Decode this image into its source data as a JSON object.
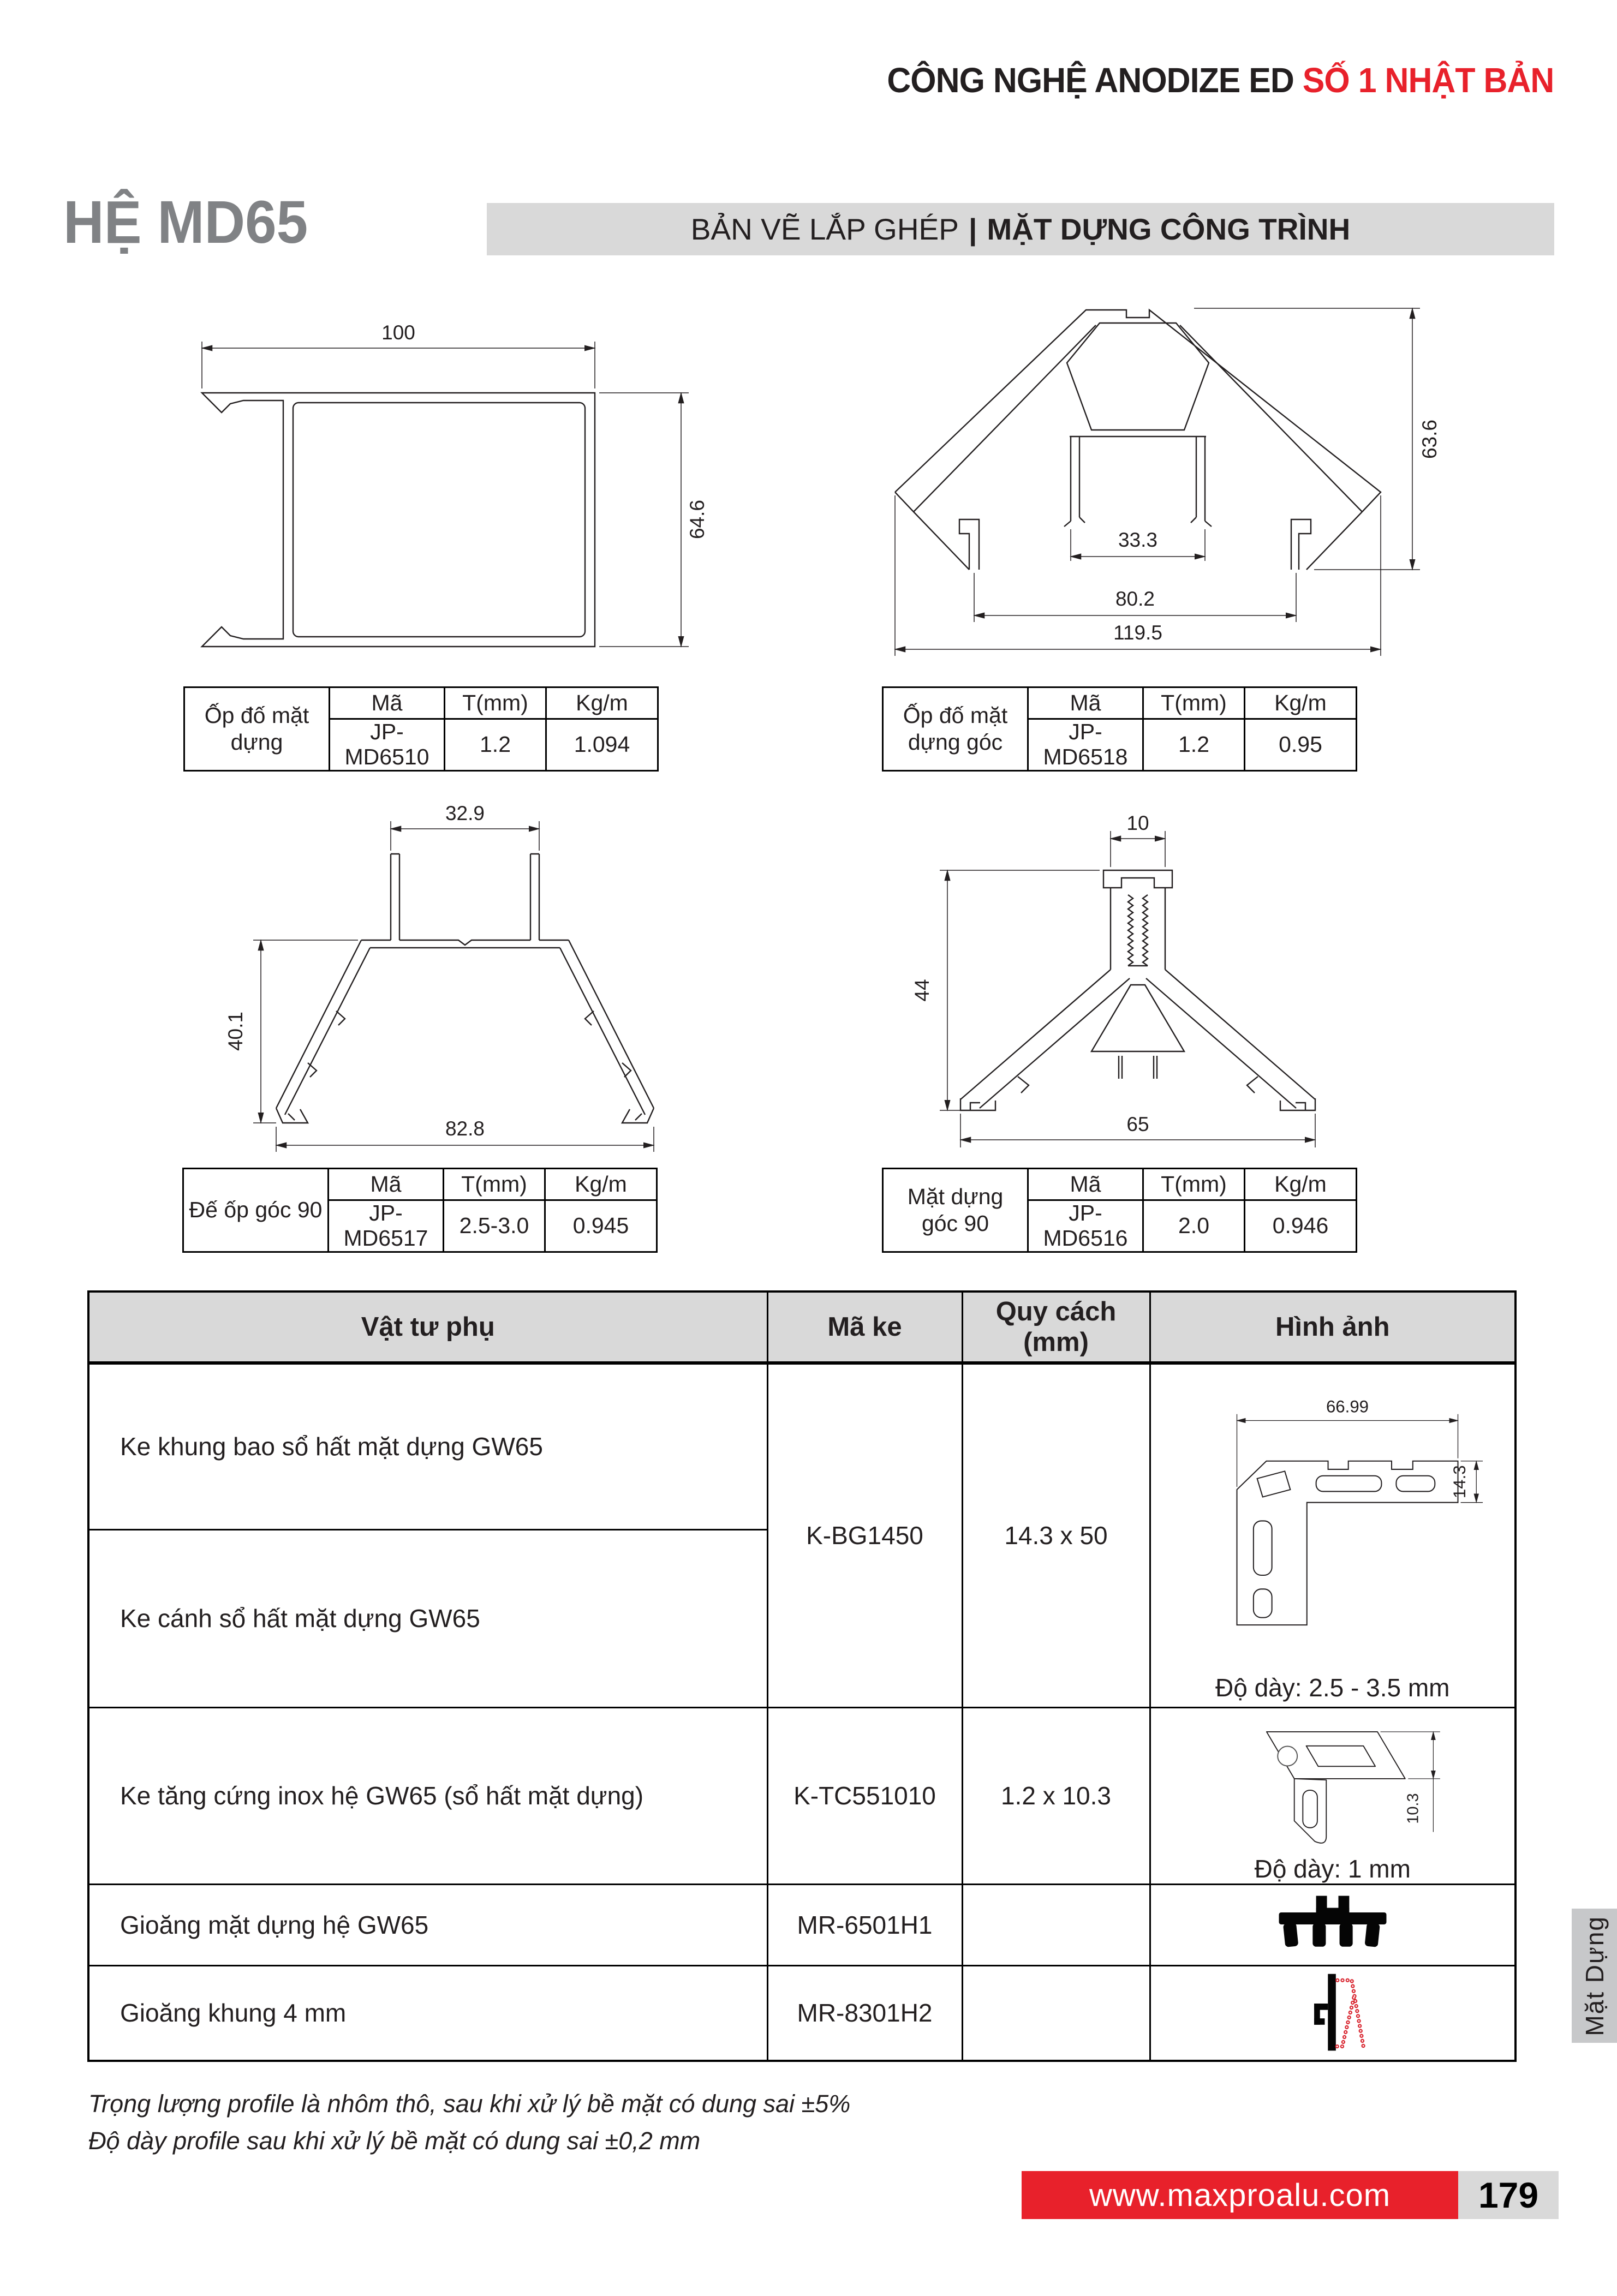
{
  "header": {
    "title_black": "CÔNG NGHỆ ANODIZE ED",
    "title_red": "SỐ 1 NHẬT BẢN"
  },
  "intro": {
    "system": "HỆ MD65",
    "banner_left": "BẢN VẼ LẮP GHÉP",
    "banner_divider": "|",
    "banner_right": "MẶT DỰNG CÔNG TRÌNH"
  },
  "mini_table_headers": {
    "ma": "Mã",
    "t": "T(mm)",
    "kg": "Kg/m"
  },
  "profiles": [
    {
      "name_l1": "Ốp đố mặt",
      "name_l2": "dựng",
      "ma": "JP-MD6510",
      "t": "1.2",
      "kg": "1.094",
      "dims": {
        "w": "100",
        "h": "64.6"
      }
    },
    {
      "name_l1": "Ốp đố mặt",
      "name_l2": "dựng góc",
      "ma": "JP-MD6518",
      "t": "1.2",
      "kg": "0.95",
      "dims": {
        "inner": "33.3",
        "h": "63.6",
        "mid": "80.2",
        "w": "119.5"
      }
    },
    {
      "name_l1": "Đế ốp góc 90",
      "name_l2": "",
      "ma": "JP-MD6517",
      "t": "2.5-3.0",
      "kg": "0.945",
      "dims": {
        "top": "32.9",
        "h": "40.1",
        "w": "82.8"
      }
    },
    {
      "name_l1": "Mặt dựng",
      "name_l2": "góc 90",
      "ma": "JP-MD6516",
      "t": "2.0",
      "kg": "0.946",
      "dims": {
        "top": "10",
        "h": "44",
        "w": "65"
      }
    }
  ],
  "accessories": {
    "headers": {
      "c1": "Vật tư phụ",
      "c2": "Mã ke",
      "c3": "Quy cách (mm)",
      "c4": "Hình ảnh"
    },
    "row1": {
      "label": "Ke khung bao sổ hất mặt dựng GW65"
    },
    "row2": {
      "label": "Ke cánh sổ hất mặt dựng GW65"
    },
    "group12": {
      "ma": "K-BG1450",
      "quycach": "14.3 x 50",
      "img_dim_w": "66.99",
      "img_dim_h": "14.3",
      "thickness": "Độ dày: 2.5 - 3.5 mm"
    },
    "row3": {
      "label": "Ke tăng cứng inox hệ GW65 (sổ hất mặt dựng)",
      "ma": "K-TC551010",
      "quycach": "1.2 x 10.3",
      "img_dim_h": "10.3",
      "thickness": "Độ dày: 1 mm"
    },
    "row4": {
      "label": "Gioăng mặt dựng hệ GW65",
      "ma": "MR-6501H1",
      "quycach": ""
    },
    "row5": {
      "label": "Gioăng khung 4 mm",
      "ma": "MR-8301H2",
      "quycach": ""
    }
  },
  "notes": {
    "line1": "Trọng lượng profile là nhôm thô, sau khi xử lý bề mặt có dung sai ±5%",
    "line2": "Độ dày profile sau khi xử lý bề mặt có dung sai ±0,2 mm"
  },
  "footer": {
    "website": "www.maxproalu.com",
    "page": "179",
    "side_tab": "Mặt Dựng"
  },
  "colors": {
    "red": "#e8212b",
    "title_gray": "#808285",
    "banner_bg": "#d9d9d9",
    "table_header_bg": "#d9d9d9",
    "tab_bg": "#c7c8ca"
  }
}
